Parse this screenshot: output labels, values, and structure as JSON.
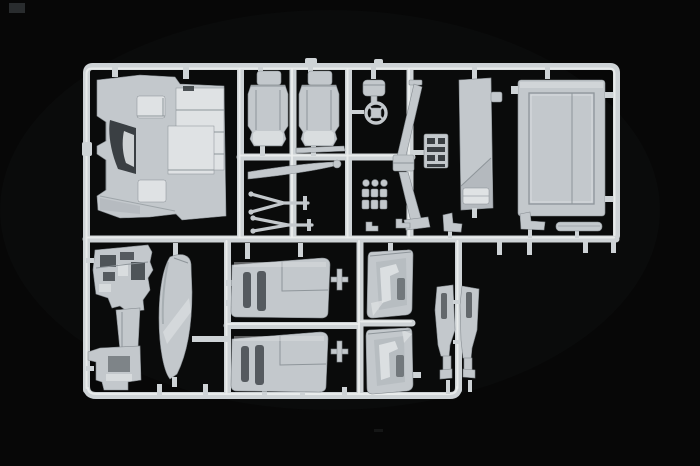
{
  "photo": {
    "subject": "plastic-model-kit-sprue",
    "background_color": "#070707",
    "colors": {
      "background": "#070707",
      "plastic": "#c3c8cc",
      "plastic_hi": "#dfe2e4",
      "plastic_lo": "#8e959a",
      "recess": "#3a3f43",
      "runner": "#ced3d6",
      "runner_hi": "#eceeef",
      "seam": "#878d92",
      "artifact": "#2e3133"
    },
    "parts": [
      "cab-floor-panel",
      "seat-left",
      "seat-right",
      "trim-strips",
      "mirror-arm-forks",
      "air-cleaner",
      "steering-wheel",
      "steering-column-upper",
      "steering-column-lower",
      "pedal-cluster",
      "knob-cluster",
      "step-panel",
      "cab-back-panel",
      "hook-parts",
      "dashboard-assembly",
      "fender-blade",
      "bunk-bed-upper",
      "bunk-bed-lower",
      "cross-fittings",
      "door-panel-upper",
      "door-panel-lower",
      "pillar-trim-left",
      "pillar-trim-right"
    ]
  }
}
